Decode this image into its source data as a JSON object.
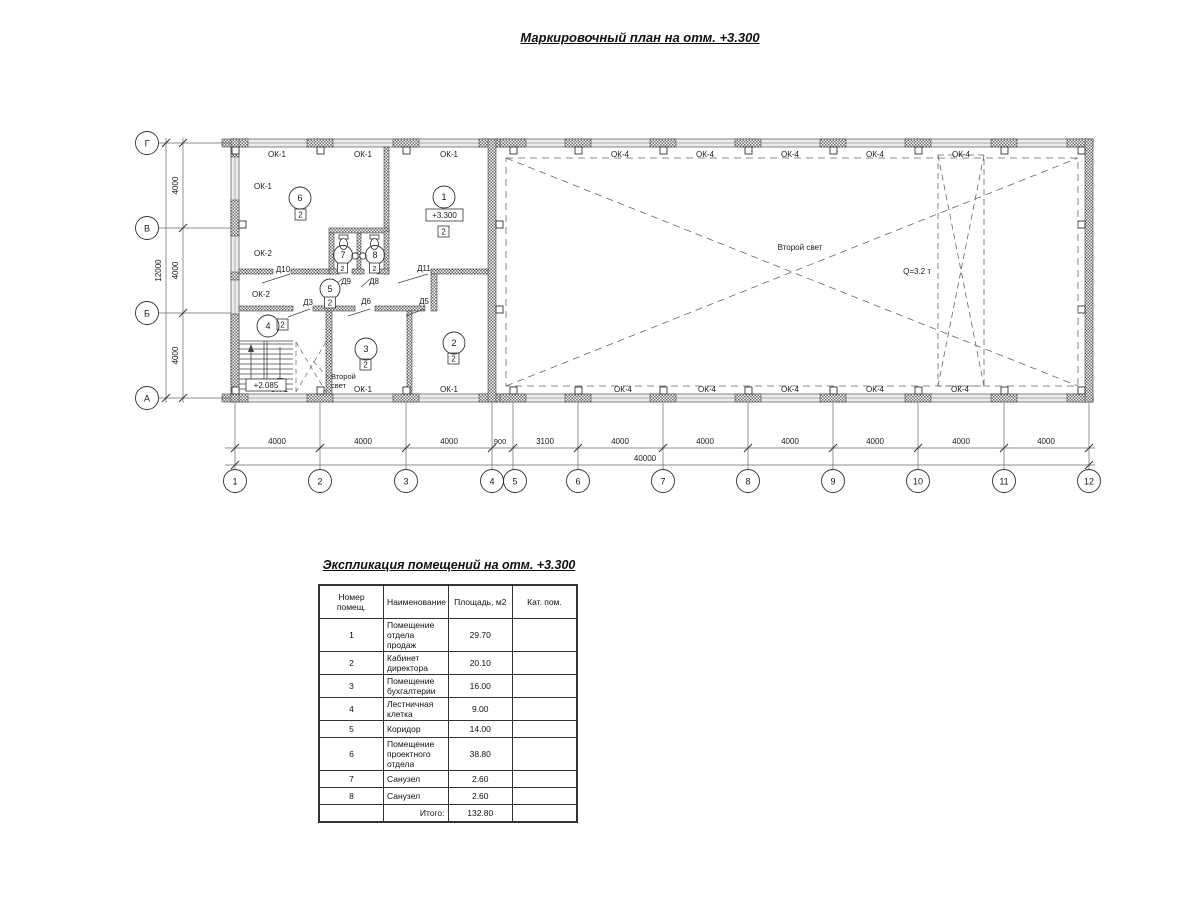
{
  "page": {
    "title_plan": "Маркировочный план на отм. +3.300"
  },
  "plan": {
    "axes_bottom": [
      "1",
      "2",
      "3",
      "4",
      "5",
      "6",
      "7",
      "8",
      "9",
      "10",
      "11",
      "12"
    ],
    "axes_left": [
      "Г",
      "В",
      "Б",
      "А"
    ],
    "dims_bottom": [
      "4000",
      "4000",
      "4000",
      "900",
      "3100",
      "4000",
      "4000",
      "4000",
      "4000",
      "4000",
      "4000"
    ],
    "dim_bottom_total": "40000",
    "dims_left": [
      "4000",
      "4000",
      "4000"
    ],
    "dim_left_total": "12000",
    "windows": {
      "ok1": "ОК-1",
      "ok2": "ОК-2",
      "ok4": "ОК-4"
    },
    "doors": {
      "d3": "Д3",
      "d5": "Д5",
      "d6": "Д6",
      "d8": "Д8",
      "d9": "Д9",
      "d10": "Д10",
      "d11": "Д11"
    },
    "marks": {
      "evac": "2",
      "elev_main": "+3.300",
      "elev_stair": "+2.085",
      "second_light": "Второй свет",
      "second_light_l1": "Второй",
      "second_light_l2": "свет",
      "crane": "Q=3.2 т"
    },
    "room_numbers": [
      "1",
      "2",
      "3",
      "4",
      "5",
      "6",
      "7",
      "8"
    ]
  },
  "schedule": {
    "title": "Экспликация помещений на отм. +3.300",
    "headers": {
      "num": "Номер помещ.",
      "name": "Наименование",
      "area": "Площадь, м2",
      "cat": "Кат. пом."
    },
    "rows": [
      {
        "num": "1",
        "name": "Помещение отдела продаж",
        "area": "29.70",
        "cat": ""
      },
      {
        "num": "2",
        "name": "Кабинет директора",
        "area": "20.10",
        "cat": ""
      },
      {
        "num": "3",
        "name": "Помещение бухгалтерии",
        "area": "16.00",
        "cat": ""
      },
      {
        "num": "4",
        "name": "Лестничная клетка",
        "area": "9.00",
        "cat": ""
      },
      {
        "num": "5",
        "name": "Коридор",
        "area": "14.00",
        "cat": ""
      },
      {
        "num": "6",
        "name": "Помещение проектного отдела",
        "area": "38.80",
        "cat": ""
      },
      {
        "num": "7",
        "name": "Санузел",
        "area": "2.60",
        "cat": ""
      },
      {
        "num": "8",
        "name": "Санузел",
        "area": "2.60",
        "cat": ""
      }
    ],
    "total_label": "Итого:",
    "total_value": "132.80"
  }
}
